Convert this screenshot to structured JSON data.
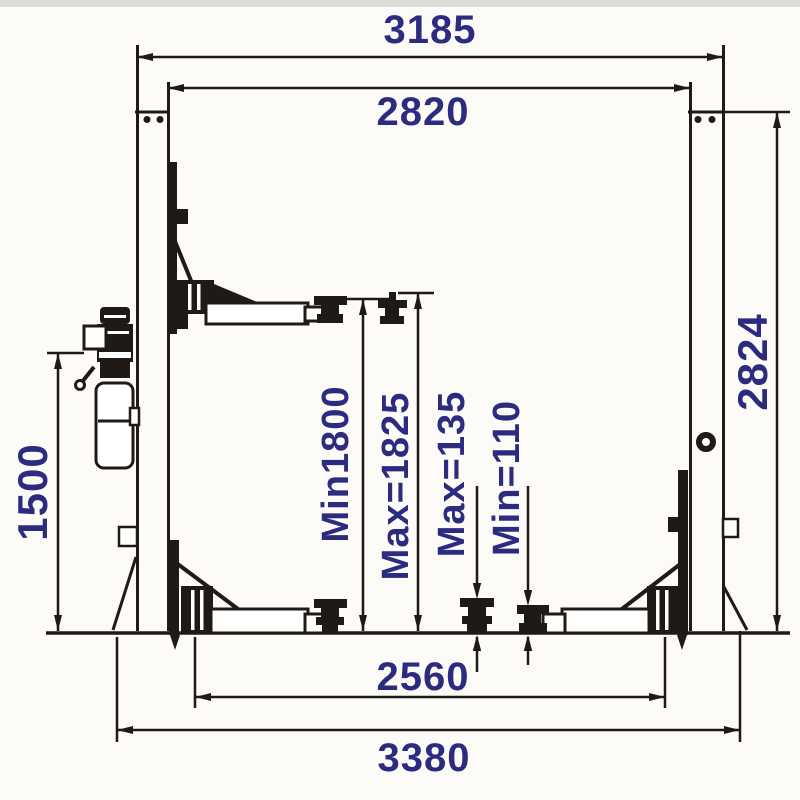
{
  "meta": {
    "description": "Two-post car lift dimensional diagram (side elevation with dimension lines in mm)"
  },
  "colors": {
    "label": "#2b2b80",
    "line": "#1f1a16",
    "background": "#fcfbf7"
  },
  "dimensions": {
    "overall_top_width": "3185",
    "inner_clear_width": "2820",
    "column_height": "2824",
    "power_unit_height": "1500",
    "lift_height_min": "Min1800",
    "lift_height_max": "Max=1825",
    "pad_height_max": "Max=135",
    "pad_height_min": "Min=110",
    "base_inner_width": "2560",
    "overall_base_width": "3380"
  }
}
